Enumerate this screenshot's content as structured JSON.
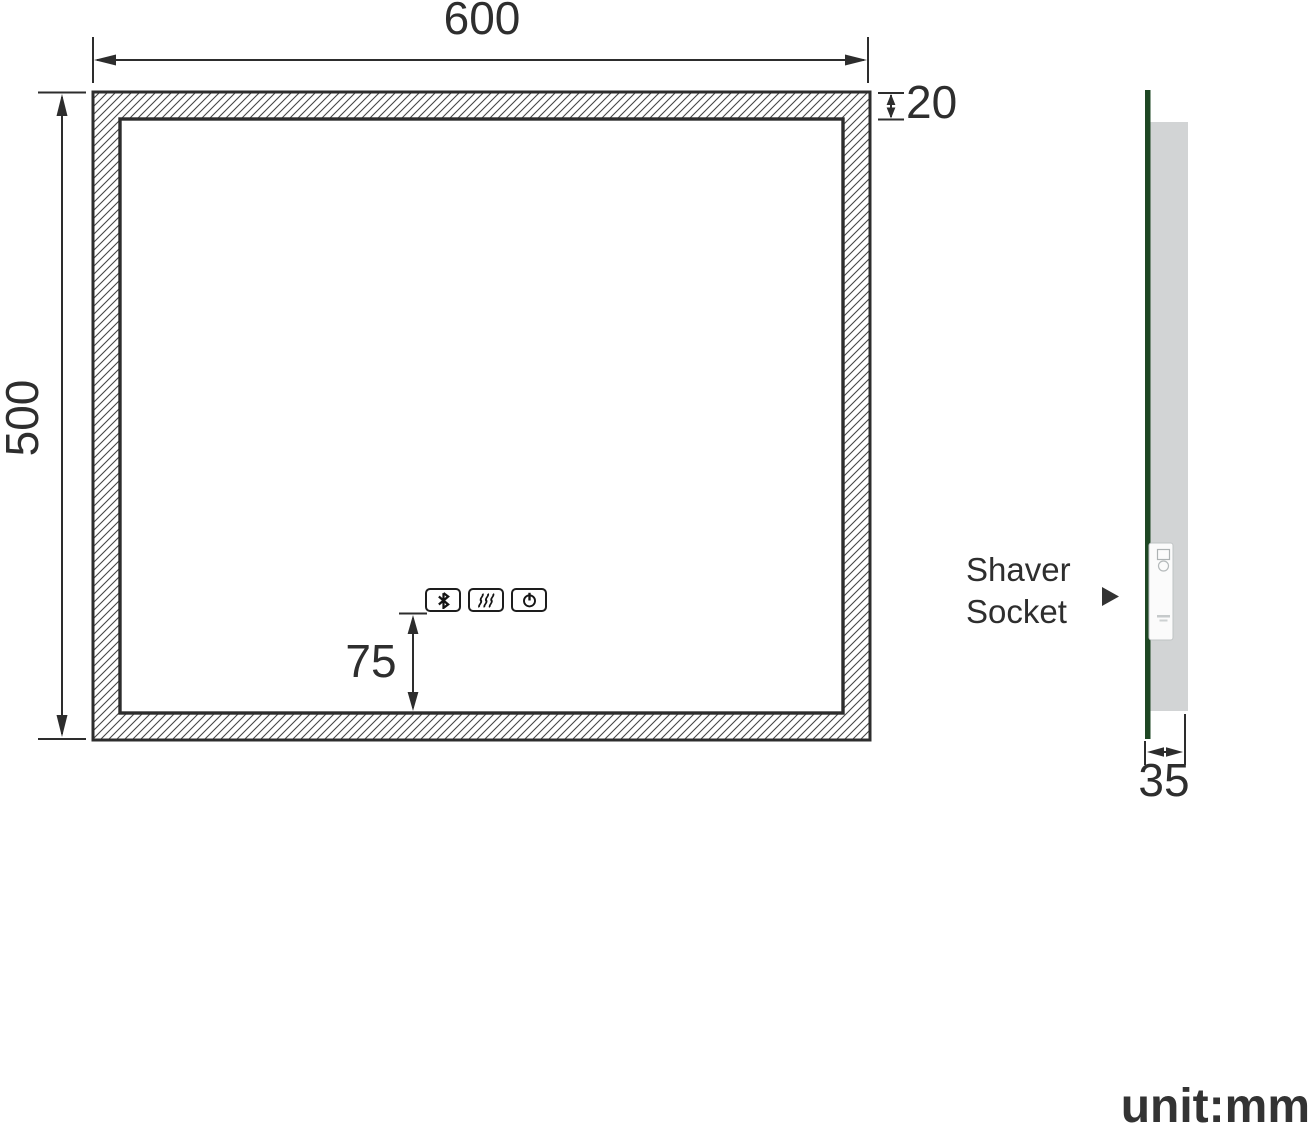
{
  "colors": {
    "line": "#2d2d2d",
    "text": "#2e2e2e",
    "glass-green": "#1e4723",
    "body-gray": "#d2d4d5",
    "socket-white": "#fbfbfb"
  },
  "front_view": {
    "width_mm": "600",
    "height_mm": "500",
    "frame_thickness_mm": "20",
    "controls_offset_mm": "75",
    "touch_buttons": [
      {
        "icon": "bluetooth-icon"
      },
      {
        "icon": "defogger-icon"
      },
      {
        "icon": "power-icon"
      }
    ]
  },
  "side_view": {
    "depth_mm": "35",
    "socket_label": "Shaver Socket"
  },
  "footer": {
    "unit_label": "unit:mm"
  }
}
